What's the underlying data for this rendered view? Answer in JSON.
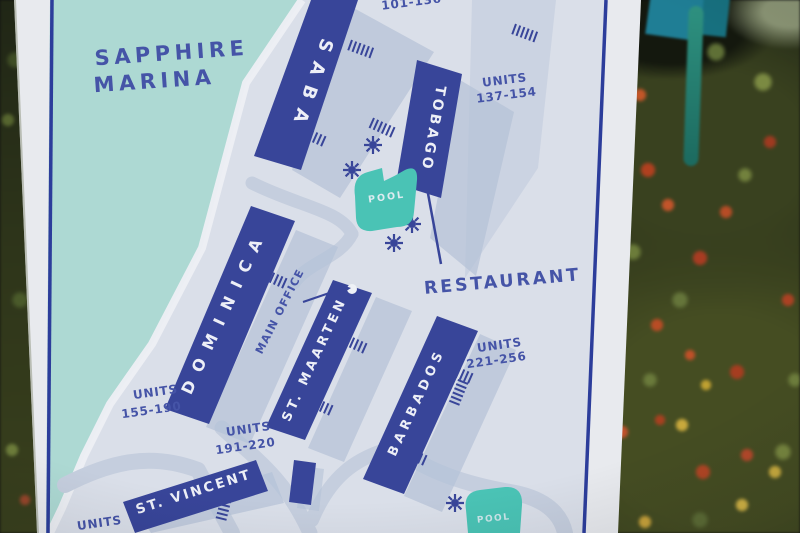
{
  "sign": {
    "board_color": "#e8eaee",
    "border_color": "#2c3d9b",
    "map": {
      "colors": {
        "water": "#a9d7d1",
        "land": "#d9dee8",
        "walkway": "#c2ccdd",
        "shadow": "#b1bfd6",
        "building": "#2e3c94",
        "label_text": "#3c4ba3",
        "building_text": "#eceff7",
        "pool": "#41c0b1",
        "shore": "#edeff4"
      },
      "marina_name": {
        "line1": "SAPPHIRE",
        "line2": "MARINA"
      },
      "buildings": [
        {
          "label": "SABA"
        },
        {
          "label": "TOBAGO"
        },
        {
          "label": "DOMINICA"
        },
        {
          "label": "ST. MAARTEN"
        },
        {
          "label": "BARBADOS"
        },
        {
          "label": "ST. VINCENT"
        }
      ],
      "unit_labels": [
        {
          "range": "101-136"
        },
        {
          "units_word": "UNITS",
          "range": "137-154"
        },
        {
          "units_word": "UNITS",
          "range": "155-190"
        },
        {
          "units_word": "UNITS",
          "range": "191-220"
        },
        {
          "units_word": "UNITS",
          "range": "221-256"
        },
        {
          "units_word": "UNITS"
        }
      ],
      "restaurant_label": "RESTAURANT",
      "main_office_label": "MAIN OFFICE",
      "pool_label": "POOL"
    }
  }
}
